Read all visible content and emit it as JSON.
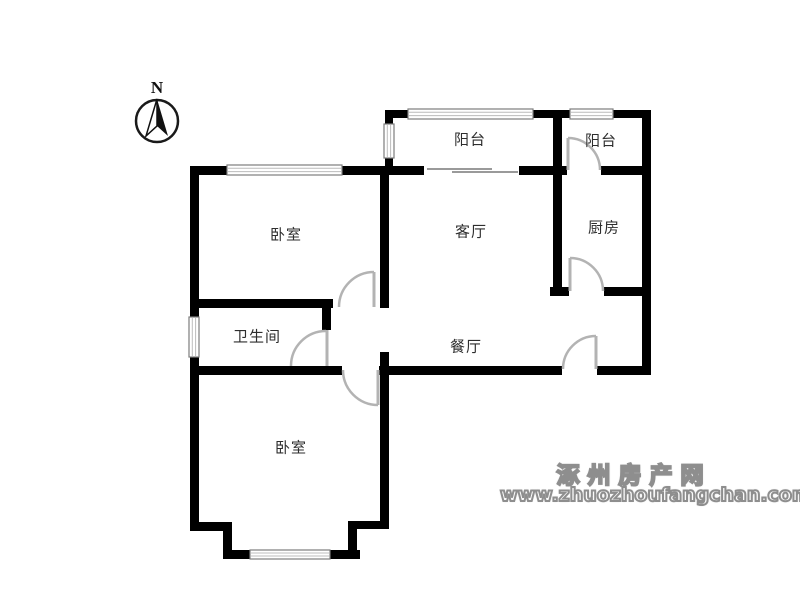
{
  "compass": {
    "north_label": "N"
  },
  "rooms": {
    "balcony_left": "阳台",
    "balcony_right": "阳台",
    "bedroom_top": "卧室",
    "living": "客厅",
    "kitchen": "厨房",
    "bathroom": "卫生间",
    "dining": "餐厅",
    "bedroom_bottom": "卧室"
  },
  "watermark": {
    "site_name": "涿州房产网",
    "url": "www.zhuozhoufangchan.com"
  },
  "colors": {
    "wall": "#000000",
    "door": "#b3b3b3",
    "window_frame": "#7d7d7d",
    "window_pane": "#bcbcbc",
    "label_text": "#2e2e2e",
    "watermark_stroke": "#8e8e8e"
  }
}
